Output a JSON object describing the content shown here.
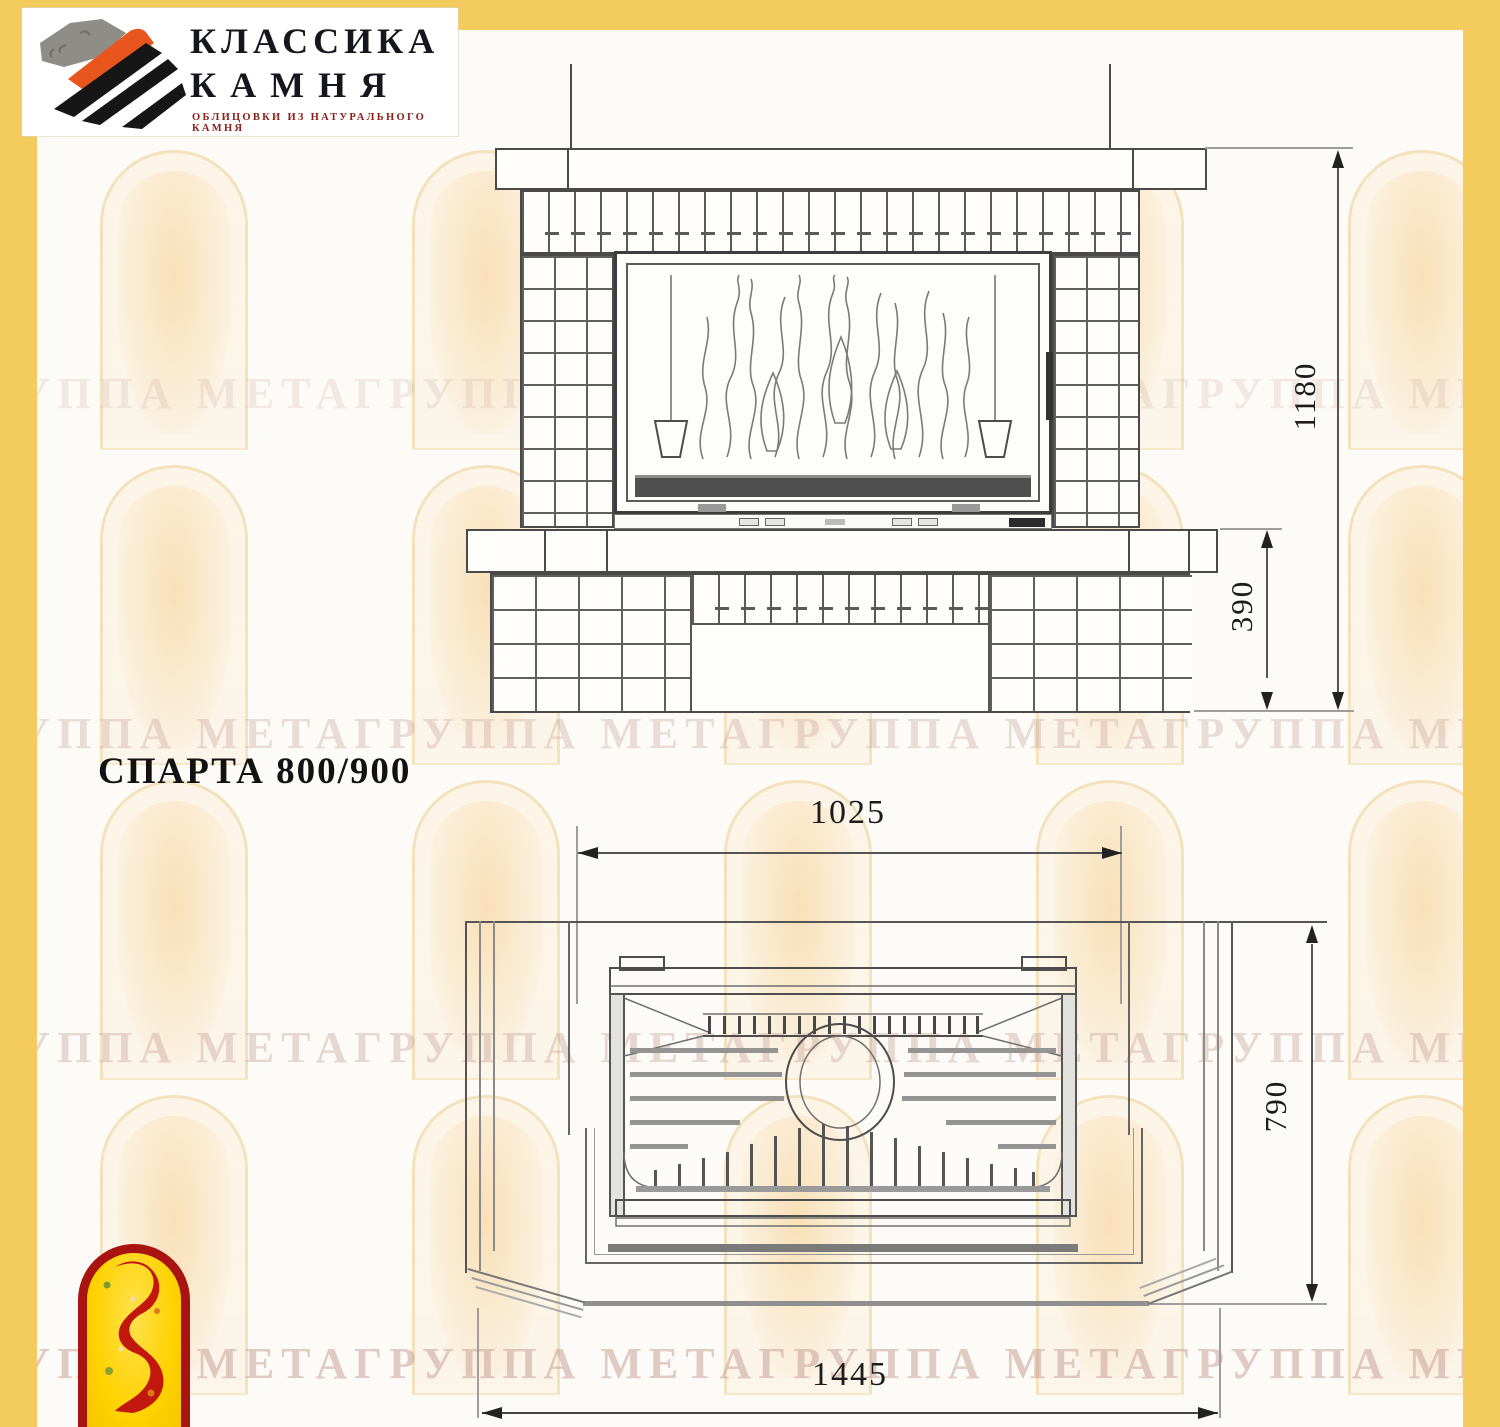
{
  "brand": {
    "name_line1": "КЛАССИКА",
    "name_line2": "КАМНЯ",
    "tagline": "ОБЛИЦОВКИ ИЗ НАТУРАЛЬНОГО КАМНЯ"
  },
  "title": "СПАРТА 800/900",
  "watermark": {
    "row_text": "ГРУППА МЕТАГРУППА МЕТАГРУППА МЕТАГРУППА МЕТА"
  },
  "views": {
    "front": {
      "dims": {
        "height_total": "1180",
        "plinth_height": "390"
      }
    },
    "plan": {
      "dims": {
        "portal_width": "1025",
        "depth": "790",
        "total_width": "1445"
      }
    }
  },
  "colors": {
    "frame_yellow": "#F3CC5D",
    "line_dark": "#4a4a4a",
    "meta_red": "#A81510",
    "meta_yellow": "#FFD200"
  }
}
